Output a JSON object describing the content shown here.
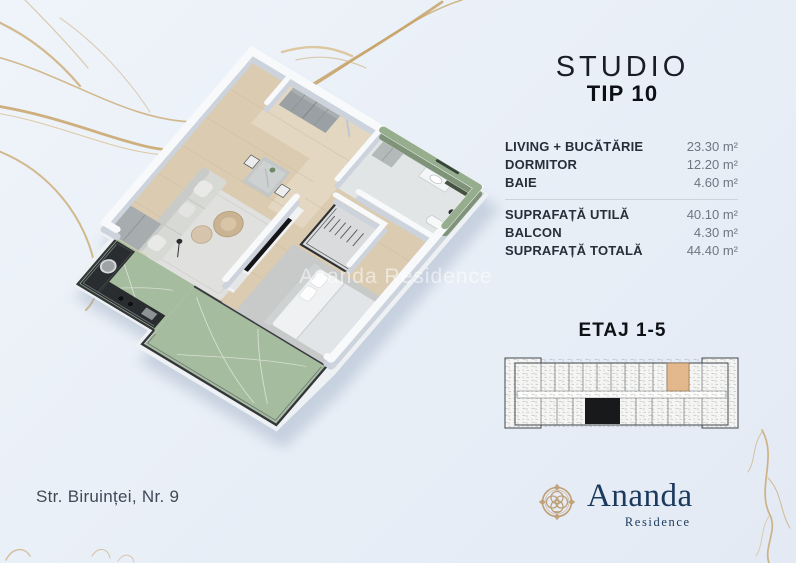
{
  "page": {
    "background": "#e9eff7",
    "vein_color": "#c69f60"
  },
  "plan3d": {
    "watermark": "Ananda Residence",
    "green_marble": "#a6bc9e",
    "wood_floor": "#dbcbb1"
  },
  "header": {
    "title": "STUDIO",
    "subtitle": "TIP 10"
  },
  "areas": {
    "rows": [
      {
        "label": "LIVING + BUCĂTĂRIE",
        "value": "23.30 m²"
      },
      {
        "label": "DORMITOR",
        "value": "12.20 m²"
      },
      {
        "label": "BAIE",
        "value": "4.60 m²"
      }
    ],
    "totals": [
      {
        "label": "SUPRAFAȚĂ UTILĂ",
        "value": "40.10 m²"
      },
      {
        "label": "BALCON",
        "value": "4.30 m²"
      },
      {
        "label": "SUPRAFAȚĂ TOTALĂ",
        "value": "44.40 m²"
      }
    ]
  },
  "floor_section": {
    "label": "ETAJ 1-5",
    "highlight_color": "#e3b385"
  },
  "footer": {
    "address": "Str. Biruinței, Nr. 9"
  },
  "brand": {
    "name": "Ananda",
    "subtitle": "Residence",
    "navy": "#1c3a5e",
    "gold": "#bf9f76"
  }
}
